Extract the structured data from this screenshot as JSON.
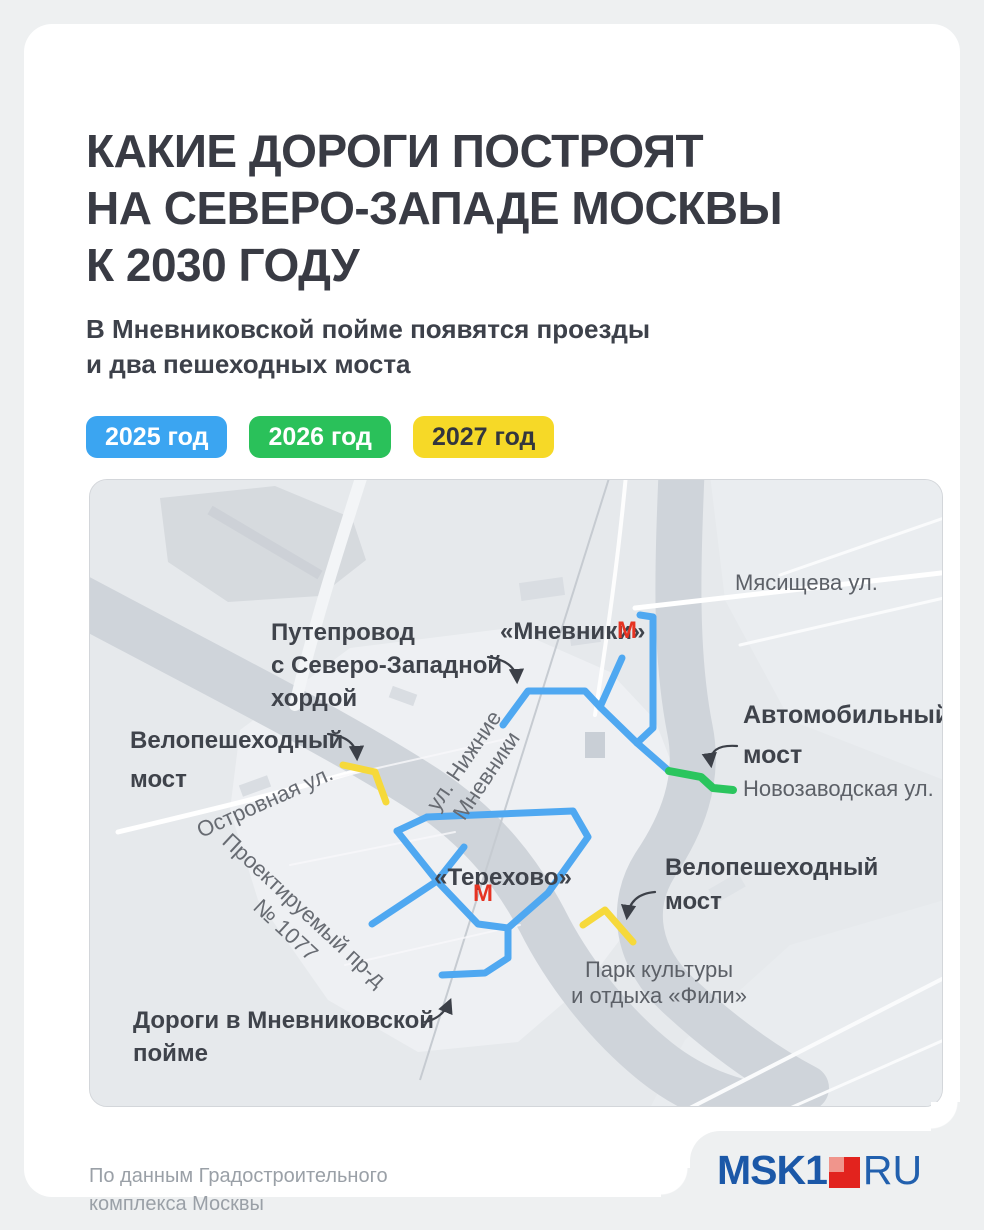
{
  "page": {
    "title": "КАКИЕ ДОРОГИ ПОСТРОЯТ\nНА СЕВЕРО-ЗАПАДЕ МОСКВЫ\nК 2030 ГОДУ",
    "subtitle": "В Мневниковской пойме появятся проезды\nи два пешеходных моста"
  },
  "legend": [
    {
      "label": "2025 год",
      "color": "#3ba5f1",
      "text_color": "#ffffff"
    },
    {
      "label": "2026 год",
      "color": "#2ac15a",
      "text_color": "#ffffff"
    },
    {
      "label": "2027 год",
      "color": "#f6d927",
      "text_color": "#33363e"
    }
  ],
  "map": {
    "labels": {
      "myasishcheva": "Мясищева ул.",
      "mnevniki": "«Мневники»",
      "putieprovod": "Путепровод\nс Северо-Западной\nхордой",
      "velo_bridge_left": "Велопешеходный\nмост",
      "ostrovnaya": "Островная ул.",
      "nizhnie_mnevniki": "ул. Нижние\nМневники",
      "avto_bridge": "Автомобильный\nмост",
      "novozavodskaya": "Новозаводская ул.",
      "terekhovo": "«Терехово»",
      "velo_bridge_right": "Велопешеходный\nмост",
      "park_fili": "Парк культуры\nи отдыха «Фили»",
      "proektiruemy": "Проектируемый пр-д\n№ 1077",
      "dorogi": "Дороги в Мневниковской\nпойме"
    },
    "metro_icon": "М",
    "colors": {
      "route_2025": "#4fa8f1",
      "route_2026": "#2bc55e",
      "route_2027": "#f6d93a",
      "river": "#cfd4da",
      "metro_red": "#e63322"
    }
  },
  "footer": {
    "source_note": "По данным Градостроительного\nкомплекса Москвы",
    "logo_msk1": "MSK1",
    "logo_ru": "RU"
  }
}
